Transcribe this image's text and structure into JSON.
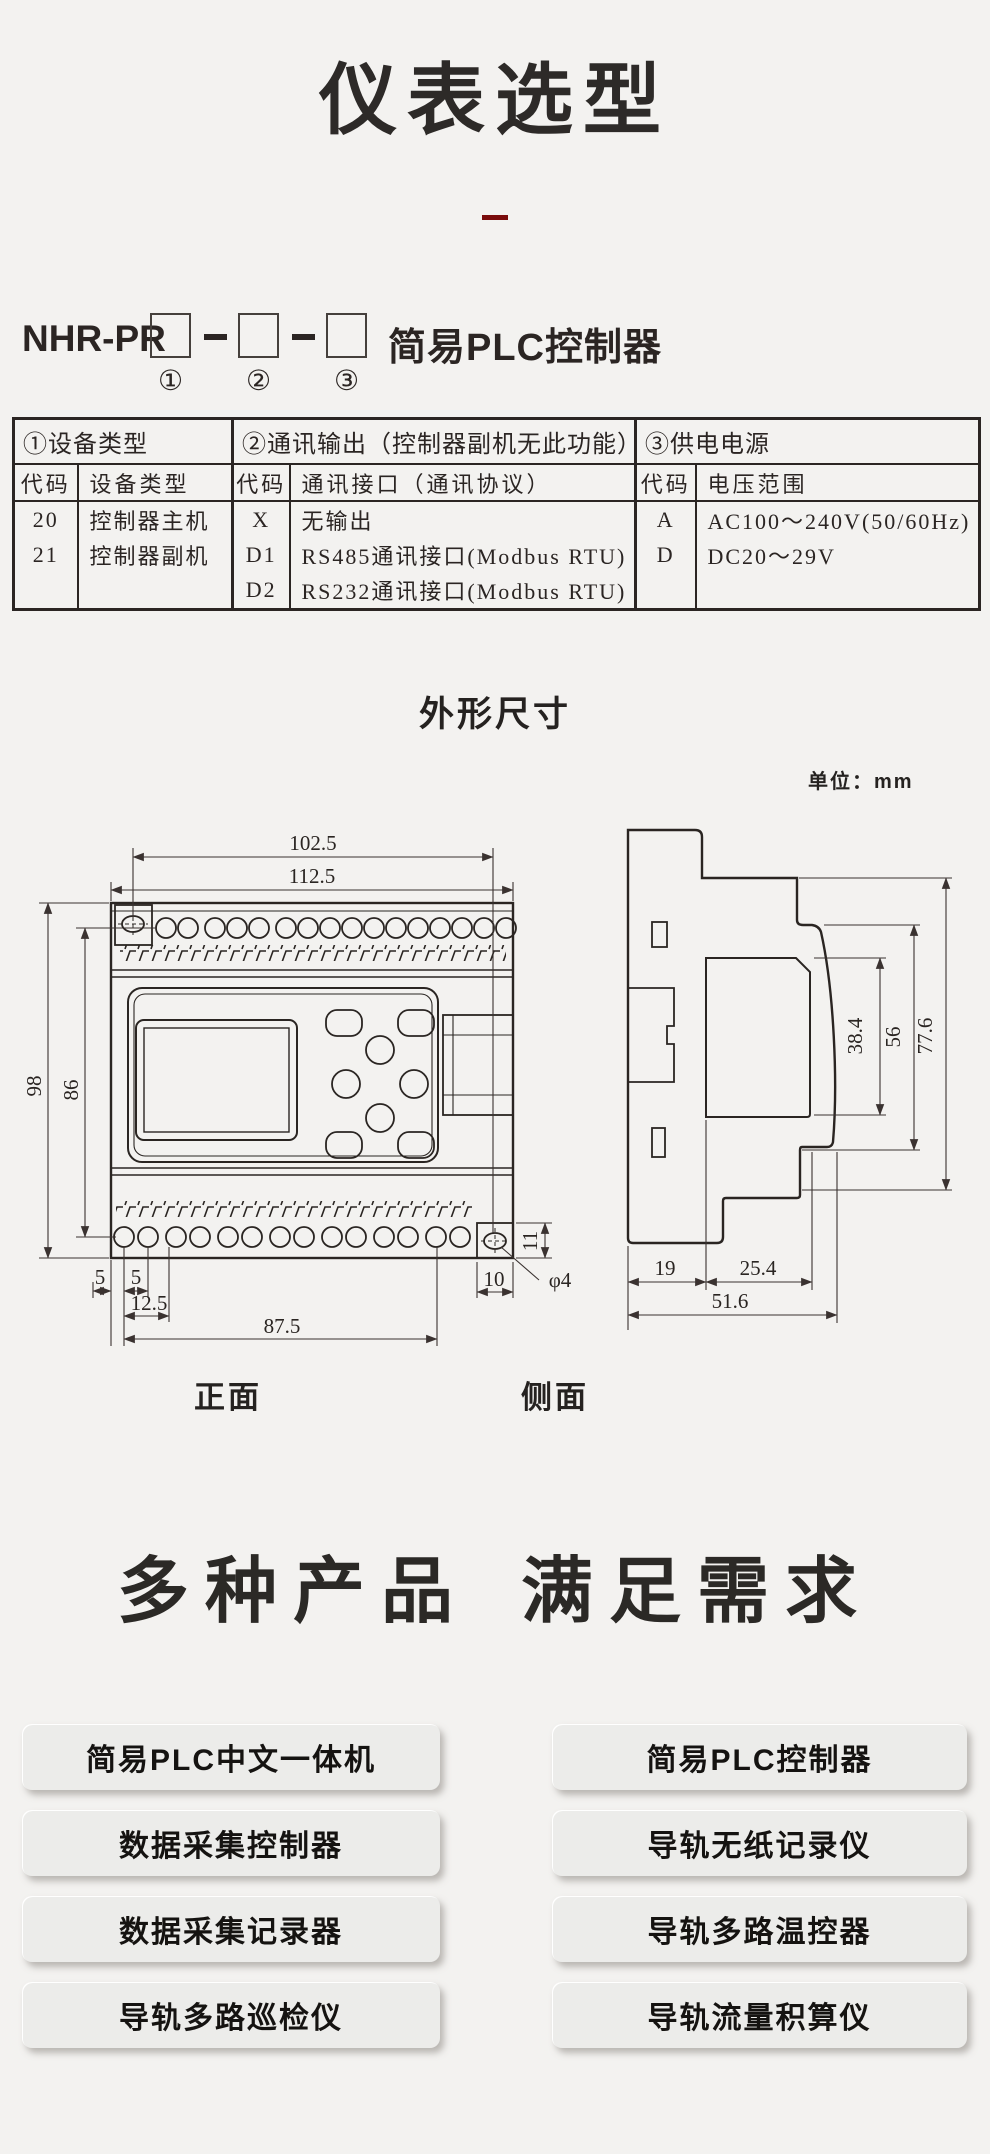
{
  "header": {
    "title": "仪表选型"
  },
  "model": {
    "prefix": "NHR-PR",
    "suffix": "简易PLC控制器",
    "markers": [
      "①",
      "②",
      "③"
    ]
  },
  "spec_table": {
    "sec1_header": "①设备类型",
    "sec2_header": "②通讯输出（控制器副机无此功能）",
    "sec3_header": "③供电电源",
    "col_code": "代码",
    "sec1_col2": "设备类型",
    "sec2_col2": "通讯接口（通讯协议）",
    "sec3_col2": "电压范围",
    "rows": [
      {
        "c1": "20",
        "v1": "控制器主机",
        "c2": "X",
        "v2": "无输出",
        "c3": "A",
        "v3": "AC100～240V(50/60Hz)"
      },
      {
        "c1": "21",
        "v1": "控制器副机",
        "c2": "D1",
        "v2": "RS485通讯接口(Modbus RTU)",
        "c3": "D",
        "v3": "DC20～29V"
      },
      {
        "c1": "",
        "v1": "",
        "c2": "D2",
        "v2": "RS232通讯接口(Modbus RTU)",
        "c3": "",
        "v3": ""
      }
    ]
  },
  "dim_section": {
    "title": "外形尺寸",
    "unit": "单位：mm",
    "front_label": "正面",
    "side_label": "侧面",
    "front_dims": {
      "w_inner": "102.5",
      "w_outer": "112.5",
      "h_outer": "98",
      "h_inner": "86",
      "m5a": "5",
      "m5b": "5",
      "m125": "12.5",
      "m875": "87.5",
      "m10": "10",
      "m11": "11",
      "hole": "φ4"
    },
    "side_dims": {
      "d384": "38.4",
      "d56": "56",
      "d776": "77.6",
      "d19": "19",
      "d254": "25.4",
      "d516": "51.6"
    }
  },
  "products": {
    "heading_left": "多种产品",
    "heading_right": "满足需求",
    "left": [
      "简易PLC中文一体机",
      "数据采集控制器",
      "数据采集记录器",
      "导轨多路巡检仪"
    ],
    "right": [
      "简易PLC控制器",
      "导轨无纸记录仪",
      "导轨多路温控器",
      "导轨流量积算仪"
    ]
  },
  "colors": {
    "accent_red": "#7a0c0c",
    "ink": "#2b2523",
    "background": "#f3f2f0"
  }
}
